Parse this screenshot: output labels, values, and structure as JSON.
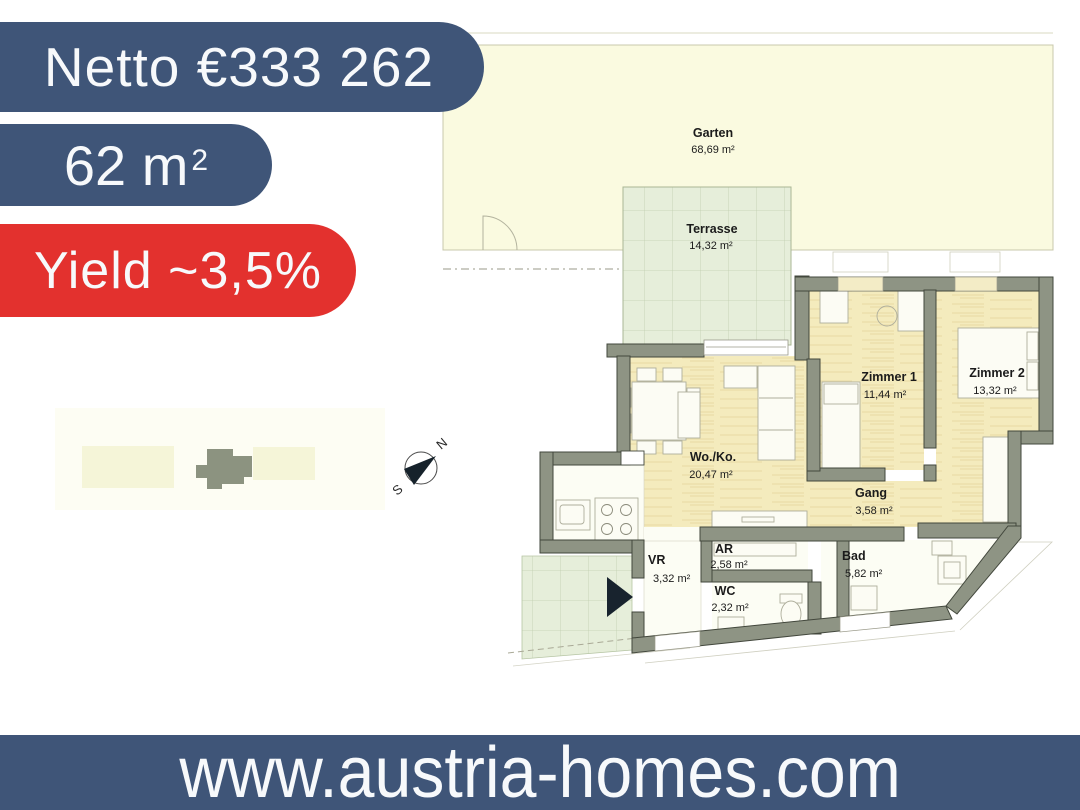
{
  "badges": {
    "price_label": "Netto €333 262",
    "area_value": "62 m",
    "area_superscript": "2",
    "yield_label": "Yield ~3,5%"
  },
  "footer": {
    "website": "www.austria-homes.com"
  },
  "floor_plan": {
    "rooms": [
      {
        "name": "Garten",
        "area": "68,69 m²"
      },
      {
        "name": "Terrasse",
        "area": "14,32 m²"
      },
      {
        "name": "Zimmer 1",
        "area": "11,44 m²"
      },
      {
        "name": "Zimmer 2",
        "area": "13,32 m²"
      },
      {
        "name": "Wo./Ko.",
        "area": "20,47 m²"
      },
      {
        "name": "Gang",
        "area": "3,58 m²"
      },
      {
        "name": "VR",
        "area": "3,32 m²"
      },
      {
        "name": "AR",
        "area": "2,58 m²"
      },
      {
        "name": "WC",
        "area": "2,32 m²"
      },
      {
        "name": "Bad",
        "area": "5,82 m²"
      }
    ],
    "compass": {
      "north": "N",
      "south": "S"
    }
  },
  "colors": {
    "badge_blue": "#3f5578",
    "badge_red": "#e3312e",
    "garden_cream": "#fafae0",
    "terrace_green": "#e6eeda",
    "floor_wheat": "#f4ebbd",
    "wall_sage": "#8e9484",
    "room_white": "#fcfdf4"
  }
}
